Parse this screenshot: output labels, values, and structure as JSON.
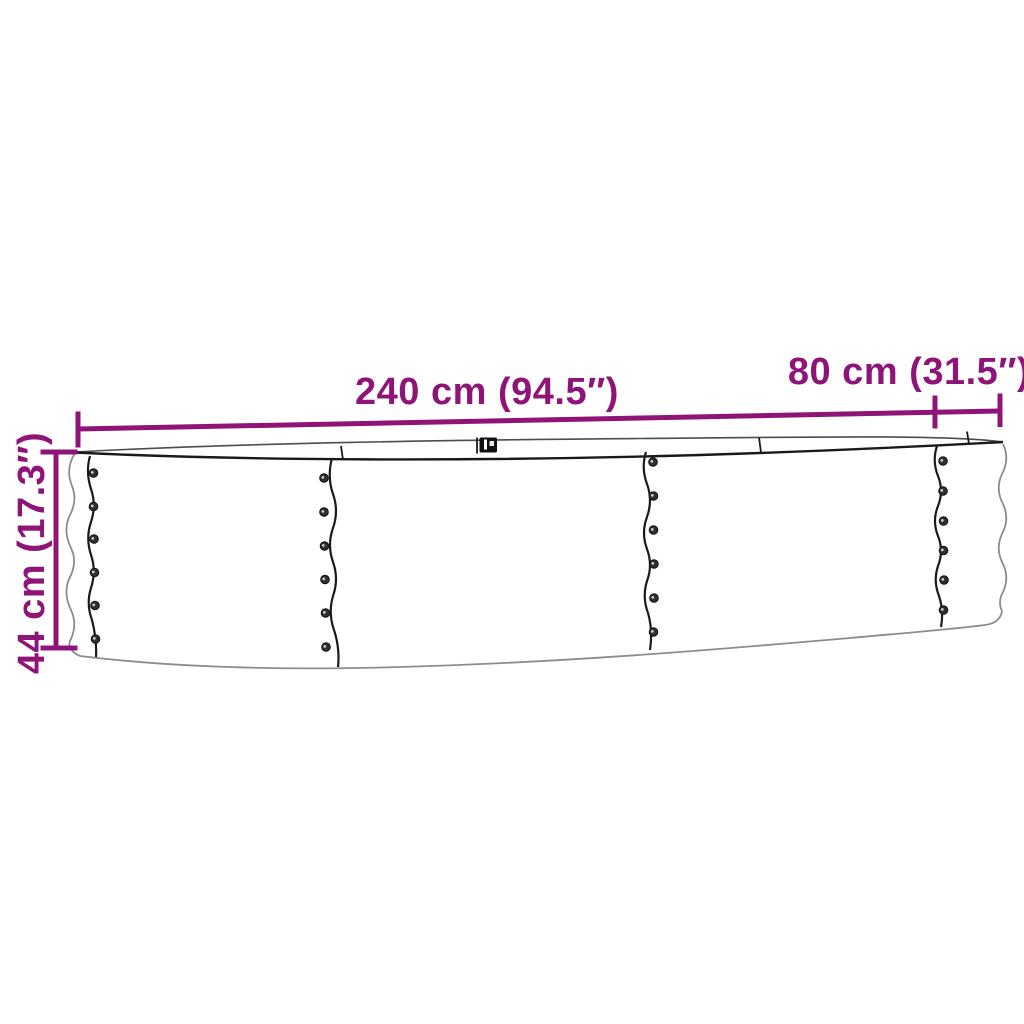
{
  "colors": {
    "accent": "#8e1577",
    "line_dark": "#1a1a1a",
    "line_mid": "#4d4d4d",
    "line_light": "#8c8c8c",
    "background": "#ffffff"
  },
  "dimensions": {
    "length_label": "240 cm (94.5″)",
    "depth_label": "80 cm (31.5″)",
    "height_label": "44 cm (17.3″)"
  }
}
